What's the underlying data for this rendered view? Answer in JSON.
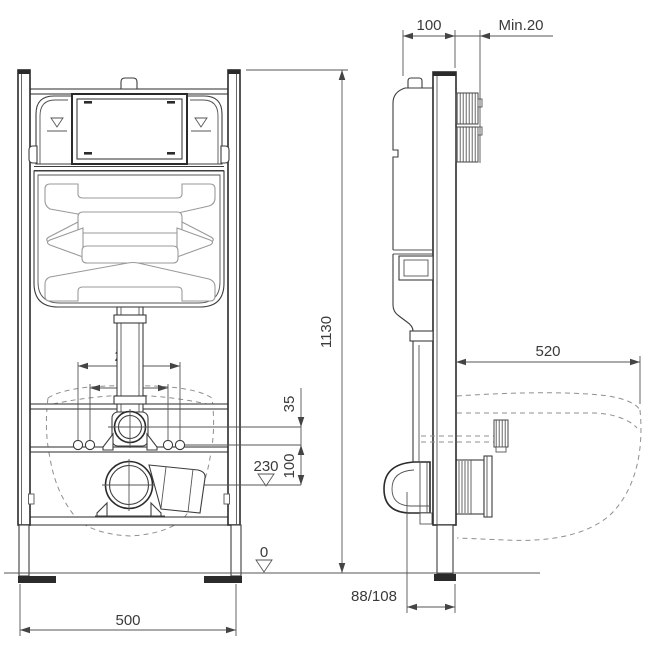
{
  "labels": {
    "bolt_spacing_outer": "230",
    "bolt_spacing_inner": "180",
    "supply_offset": "35",
    "bolt_drain_gap": "100",
    "drain_height_level": "230",
    "floor_level": "0",
    "frame_width": "500",
    "frame_height": "1130",
    "frame_depth": "100",
    "wall_min_thickness": "Min.20",
    "bowl_depth": "520",
    "drain_wall_offset": "88/108"
  },
  "colors": {
    "line": "#2b2b2b",
    "dimension": "#555555",
    "dashed_outline": "#8f8f8f",
    "background": "#ffffff"
  }
}
